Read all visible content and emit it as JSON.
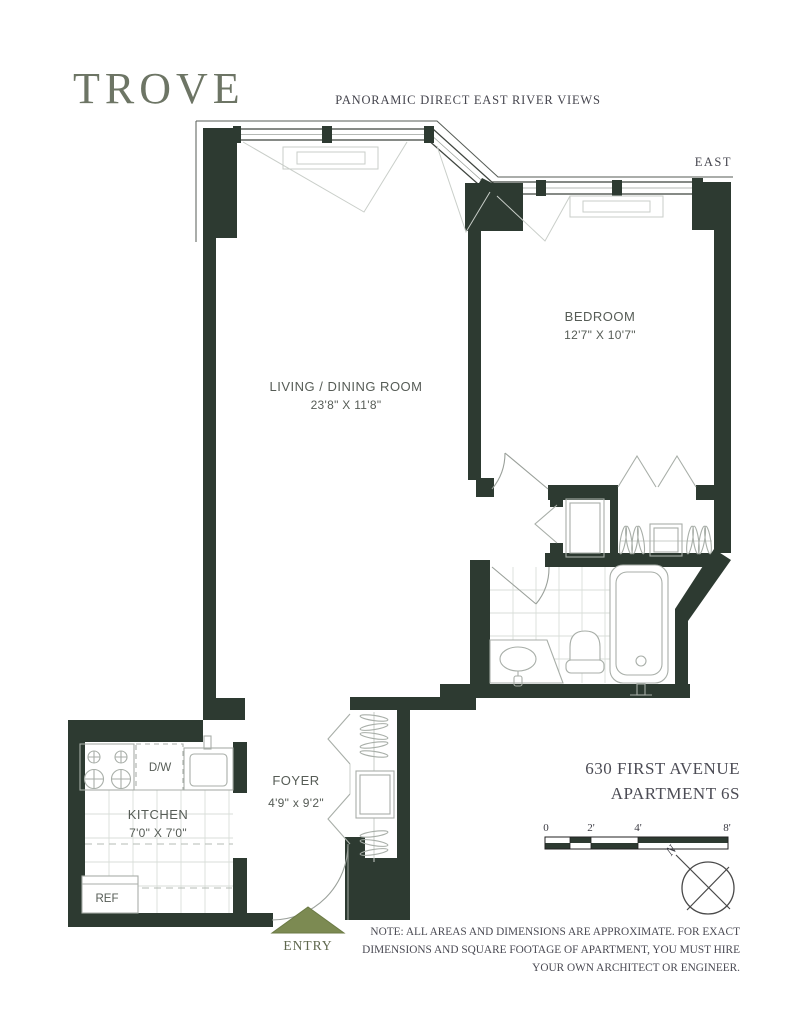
{
  "brand": "TROVE",
  "tagline": "PANORAMIC DIRECT EAST RIVER VIEWS",
  "compass_direction": "EAST",
  "rooms": {
    "living_dining": {
      "name": "LIVING / DINING ROOM",
      "dims": "23'8\" X 11'8\""
    },
    "bedroom": {
      "name": "BEDROOM",
      "dims": "12'7\" X 10'7\""
    },
    "kitchen": {
      "name": "KITCHEN",
      "dims": "7'0\" X 7'0\""
    },
    "foyer": {
      "name": "FOYER",
      "dims": "4'9\" x 9'2\""
    }
  },
  "appliances": {
    "dishwasher": "D/W",
    "refrigerator": "REF"
  },
  "entry_label": "ENTRY",
  "address": {
    "line1": "630 FIRST AVENUE",
    "line2": "APARTMENT 6S"
  },
  "scale": {
    "tick0": "0",
    "tick2": "2'",
    "tick4": "4'",
    "tick8": "8'"
  },
  "compass_north": "N",
  "note": {
    "line1": "NOTE: ALL AREAS AND DIMENSIONS ARE APPROXIMATE. FOR EXACT",
    "line2": "DIMENSIONS AND SQUARE FOOTAGE OF APARTMENT, YOU MUST HIRE",
    "line3": "YOUR OWN ARCHITECT OR ENGINEER."
  },
  "colors": {
    "wall": "#2d3a31",
    "accent_olive": "#7c8a52",
    "logo": "#6d7565",
    "text_dark": "#45454e",
    "label_gray": "#565c56"
  }
}
